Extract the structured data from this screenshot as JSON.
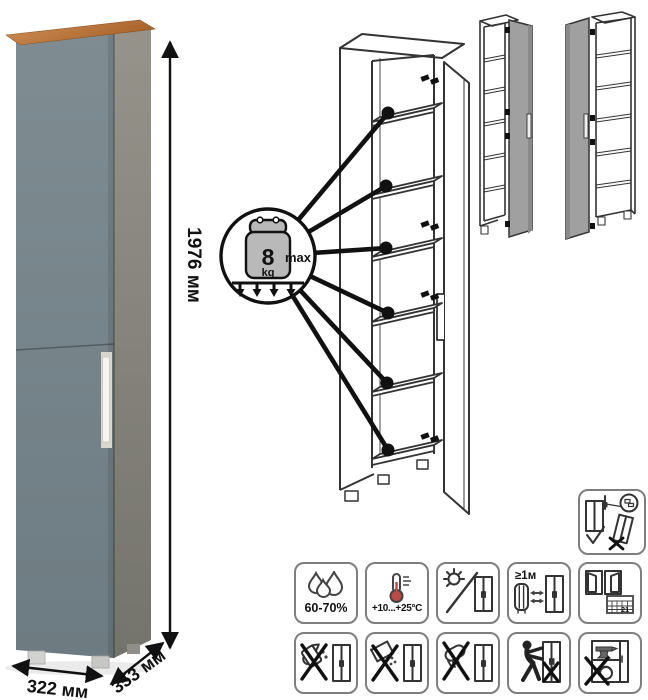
{
  "dimensions": {
    "height_label": "1976 мм",
    "width_label": "322 мм",
    "depth_label": "353 мм"
  },
  "load_callout": {
    "weight": "8",
    "unit": "kg",
    "max_label": "max",
    "shelves_marked": 6
  },
  "environment_icons": [
    {
      "name": "humidity-icon",
      "label": "60-70%"
    },
    {
      "name": "temperature-icon",
      "label": "+10...+25°C"
    },
    {
      "name": "no-direct-sunlight-icon",
      "label": ""
    },
    {
      "name": "distance-from-heat-icon",
      "label": "≥1м"
    },
    {
      "name": "ventilation-calendar-icon",
      "label": "21"
    }
  ],
  "care_icons": [
    {
      "name": "no-pouring-liquids-icon"
    },
    {
      "name": "no-abrasive-powder-icon"
    },
    {
      "name": "no-wet-cloth-icon"
    },
    {
      "name": "no-dragging-icon"
    },
    {
      "name": "no-overloading-icon"
    }
  ],
  "safety_icon": {
    "name": "anchor-to-wall-warning-icon"
  },
  "variants": [
    {
      "name": "door-hinged-right-variant"
    },
    {
      "name": "door-hinged-left-variant"
    }
  ],
  "colors": {
    "front_gray": "#76848b",
    "side_gray": "#8d8a82",
    "wood_top": "#bd7a42",
    "handle": "#f4f2ec",
    "line_art": "#333333",
    "thermometer_red": "#b94a48"
  }
}
